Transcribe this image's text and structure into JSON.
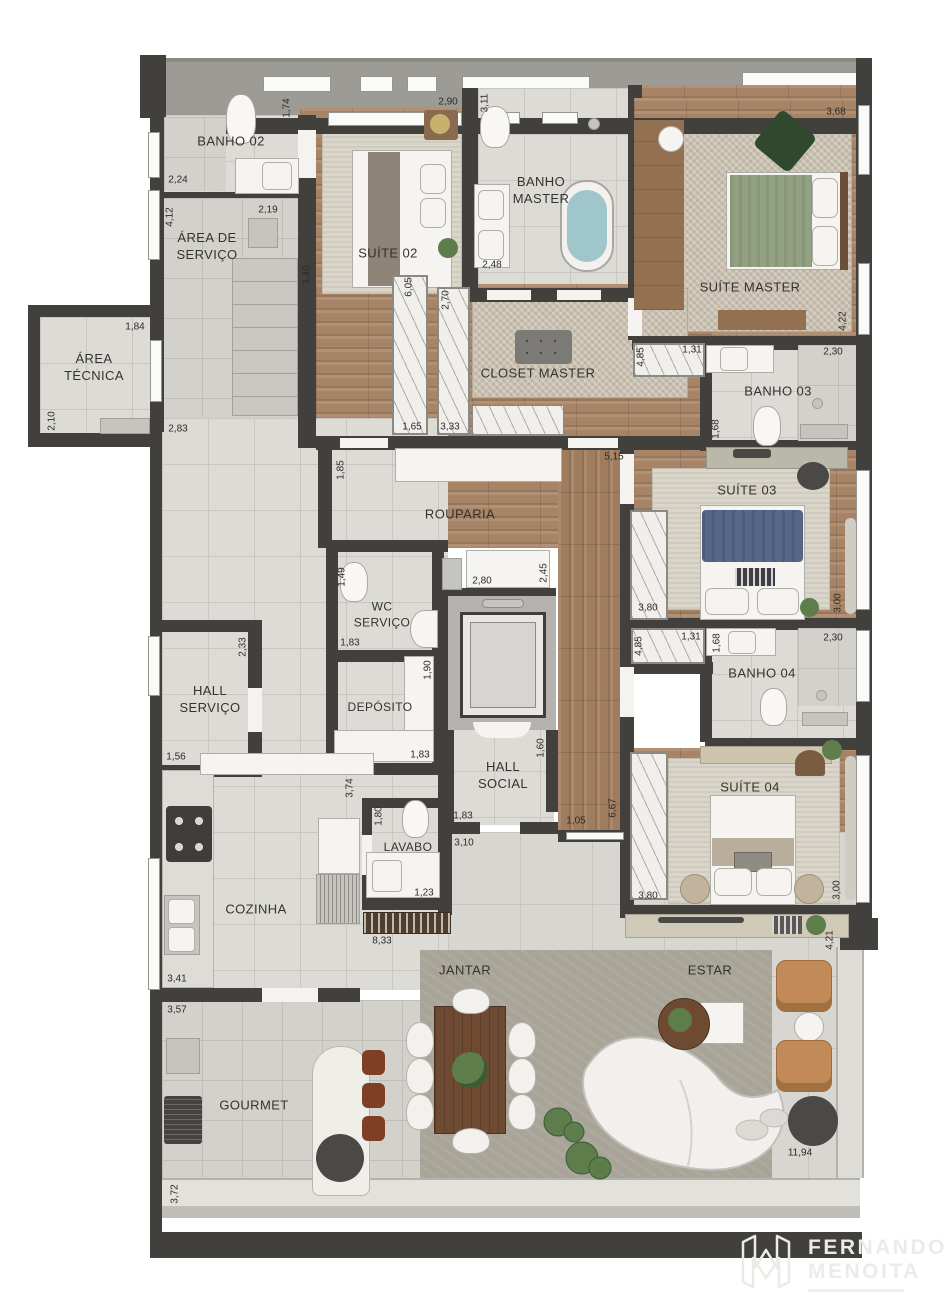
{
  "rooms": {
    "banho02": "BANHO 02",
    "area_servico": "ÁREA DE SERVIÇO",
    "area_tecnica": "ÁREA TÉCNICA",
    "suite02": "SUÍTE 02",
    "banho_master": "BANHO MASTER",
    "suite_master": "SUÍTE MASTER",
    "closet_master": "CLOSET MASTER",
    "banho03": "BANHO 03",
    "suite03": "SUÍTE 03",
    "rouparia": "ROUPARIA",
    "wc_servico": "WC SERVIÇO",
    "hall_servico": "HALL SERVIÇO",
    "deposito": "DEPÓSITO",
    "hall_social": "HALL SOCIAL",
    "banho04": "BANHO 04",
    "suite04": "SUÍTE 04",
    "lavabo": "LAVABO",
    "cozinha": "COZINHA",
    "gourmet": "GOURMET",
    "jantar": "JANTAR",
    "estar": "ESTAR"
  },
  "dims": {
    "d_174": "1,74",
    "d_290": "2,90",
    "d_311": "3,11",
    "d_368": "3,68",
    "d_224": "2,24",
    "d_412": "4,12",
    "d_219": "2,19",
    "d_184": "1,84",
    "d_210": "2,10",
    "d_283": "2,83",
    "d_340": "3,40",
    "d_248": "2,48",
    "d_422": "4,22",
    "d_605": "6,05",
    "d_270": "2,70",
    "d_165": "1,65",
    "d_333": "3,33",
    "d_485a": "4,85",
    "d_131a": "1,31",
    "d_230a": "2,30",
    "d_168a": "1,68",
    "d_380a": "3,80",
    "d_300a": "3,00",
    "d_185": "1,85",
    "d_515": "5,15",
    "d_280": "2,80",
    "d_245": "2,45",
    "d_149": "1,49",
    "d_183a": "1,83",
    "d_233": "2,33",
    "d_156": "1,56",
    "d_190": "1,90",
    "d_183b": "1,83",
    "d_160": "1,60",
    "d_183c": "1,83",
    "d_310": "3,10",
    "d_105": "1,05",
    "d_667": "6,67",
    "d_374": "3,74",
    "d_180": "1,80",
    "d_123": "1,23",
    "d_485b": "4,85",
    "d_131b": "1,31",
    "d_230b": "2,30",
    "d_168b": "1,68",
    "d_380b": "3,80",
    "d_300b": "3,00",
    "d_341": "3,41",
    "d_357": "3,57",
    "d_833": "8,33",
    "d_372": "3,72",
    "d_421": "4,21",
    "d_1194": "11,94"
  },
  "watermark": {
    "line1": "FERNANDO",
    "line2": "MENOITA"
  }
}
